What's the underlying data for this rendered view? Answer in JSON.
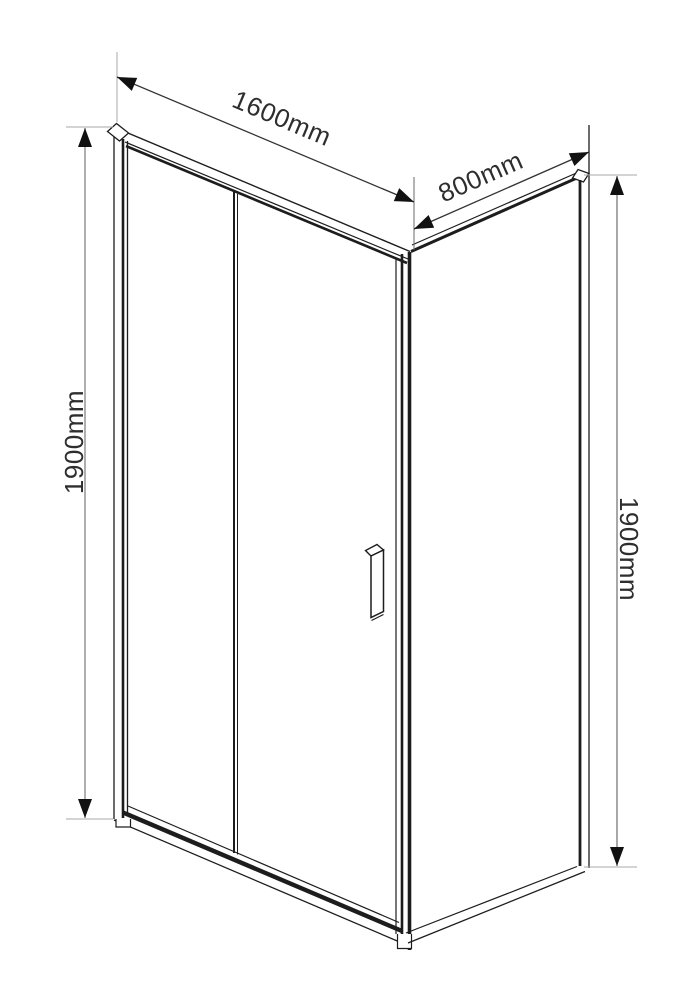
{
  "diagram": {
    "type": "technical-drawing",
    "subject": "sliding-door-shower-enclosure-with-side-panel",
    "labels": {
      "width": "1600mm",
      "depth": "800mm",
      "height_left": "1900mm",
      "height_right": "1900mm"
    },
    "colors": {
      "background": "#ffffff",
      "outline": "#1d1d1d",
      "dimension_line": "#777777",
      "extension_line": "#a8a8a8",
      "arrowhead": "#111111",
      "text": "#2e2e2e"
    }
  }
}
